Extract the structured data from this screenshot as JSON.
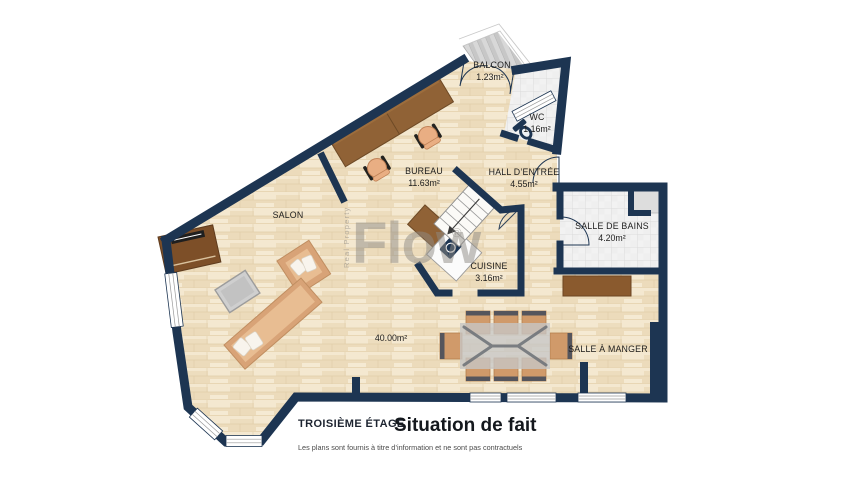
{
  "watermark": {
    "brand": "Flow",
    "registered": "®",
    "tagline": "Real Property"
  },
  "rooms": {
    "balcon": {
      "name": "BALCON",
      "area": "1.23m²"
    },
    "wc": {
      "name": "WC",
      "area": "1.16m²"
    },
    "bureau": {
      "name": "BUREAU",
      "area": "11.63m²"
    },
    "hall": {
      "name": "HALL D’ENTRÉE",
      "area": "4.55m²"
    },
    "salon": {
      "name": "SALON"
    },
    "salle_de_bains": {
      "name": "SALLE DE BAINS",
      "area": "4.20m²"
    },
    "cuisine": {
      "name": "CUISINE",
      "area": "3.16m²"
    },
    "salle_a_manger": {
      "name": "SALLE À MANGER"
    },
    "surface_totale": "40.00m²"
  },
  "footer": {
    "floor_label": "TROISIÈME ÉTAGE",
    "title": "Situation de fait",
    "disclaimer": "Les plans sont fournis à titre d’information et ne sont pas contractuels"
  },
  "colors": {
    "wall": "#1d3552",
    "floor": "#f1e3c9",
    "tile": "#f2f2f2",
    "wood_furniture": "#8f6134",
    "sofa": "#ecc096"
  }
}
